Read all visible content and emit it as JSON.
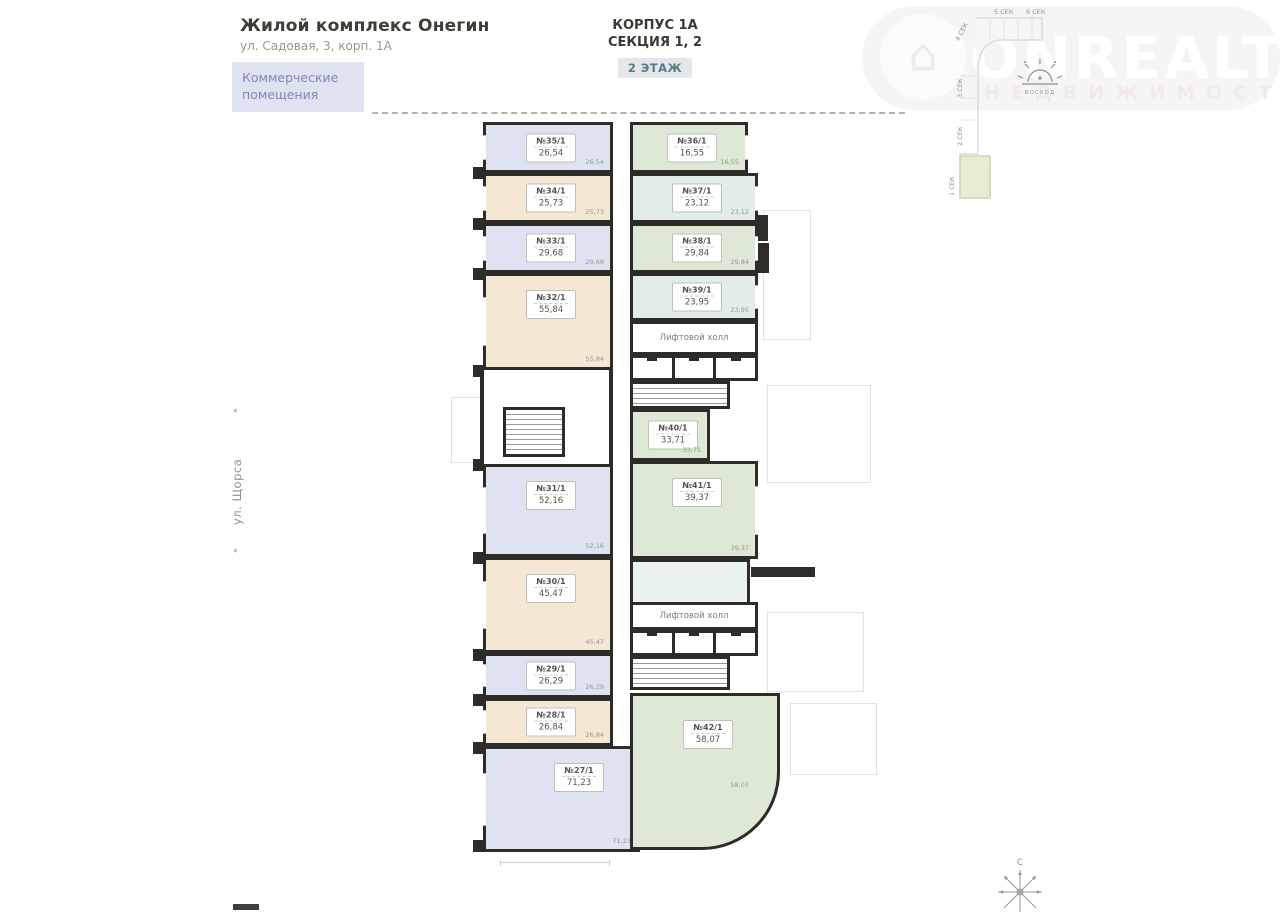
{
  "header": {
    "project_title": "Жилой комплекс Онегин",
    "address": "ул. Садовая, 3, корп. 1А",
    "commercial_badge": "Коммерческие помещения",
    "building": "КОРПУС 1А",
    "section": "СЕКЦИЯ 1, 2",
    "floor_badge": "2 ЭТАЖ"
  },
  "street_label": "ул. Щорса",
  "watermark": {
    "brand": "ONREALT",
    "subtitle": "НЕДВИЖИМОСТЬ"
  },
  "minimap": {
    "sections": [
      "4 СЕК",
      "5 СЕК",
      "6 СЕК",
      "3 СЕК",
      "2 СЕК",
      "1 СЕК"
    ],
    "sun_label": "ВОСХОД"
  },
  "compass": {
    "north_label": "С"
  },
  "floorplan": {
    "lift_hall_label": "Лифтовой холл",
    "colors": {
      "wall": "#2d2c29",
      "lavender": "#dfe3f1",
      "beige": "#f4e7d3",
      "green": "#dde8d6",
      "teal": "#e1eceb"
    },
    "rooms": [
      {
        "id": "r35",
        "number": "№35/1",
        "area": "26,54",
        "corner": "26,54",
        "color": "lavender"
      },
      {
        "id": "r34",
        "number": "№34/1",
        "area": "25,73",
        "corner": "25,73",
        "color": "beige"
      },
      {
        "id": "r33",
        "number": "№33/1",
        "area": "29,68",
        "corner": "29,68",
        "color": "lavender"
      },
      {
        "id": "r32",
        "number": "№32/1",
        "area": "55,84",
        "corner": "55,84",
        "color": "beige"
      },
      {
        "id": "r31",
        "number": "№31/1",
        "area": "52,16",
        "corner": "52,16",
        "color": "lavender"
      },
      {
        "id": "r30",
        "number": "№30/1",
        "area": "45,47",
        "corner": "45,47",
        "color": "beige"
      },
      {
        "id": "r29",
        "number": "№29/1",
        "area": "26,29",
        "corner": "26,29",
        "color": "lavender"
      },
      {
        "id": "r28",
        "number": "№28/1",
        "area": "26,84",
        "corner": "26,84",
        "color": "beige"
      },
      {
        "id": "r27",
        "number": "№27/1",
        "area": "71,23",
        "corner": "71,23",
        "color": "lavender"
      },
      {
        "id": "r36",
        "number": "№36/1",
        "area": "16,55",
        "corner": "16,55",
        "color": "green"
      },
      {
        "id": "r37",
        "number": "№37/1",
        "area": "23,12",
        "corner": "23,12",
        "color": "teal"
      },
      {
        "id": "r38",
        "number": "№38/1",
        "area": "29,84",
        "corner": "29,84",
        "color": "green"
      },
      {
        "id": "r39",
        "number": "№39/1",
        "area": "23,95",
        "corner": "23,95",
        "color": "teal"
      },
      {
        "id": "r40",
        "number": "№40/1",
        "area": "33,71",
        "corner": "33,71",
        "color": "green"
      },
      {
        "id": "r41",
        "number": "№41/1",
        "area": "39,37",
        "corner": "39,37",
        "color": "green"
      },
      {
        "id": "r42",
        "number": "№42/1",
        "area": "58,07",
        "corner": "58,07",
        "color": "green"
      }
    ],
    "utility_cells": [
      "2,76",
      "5,16",
      "2,40",
      "5,16"
    ]
  }
}
